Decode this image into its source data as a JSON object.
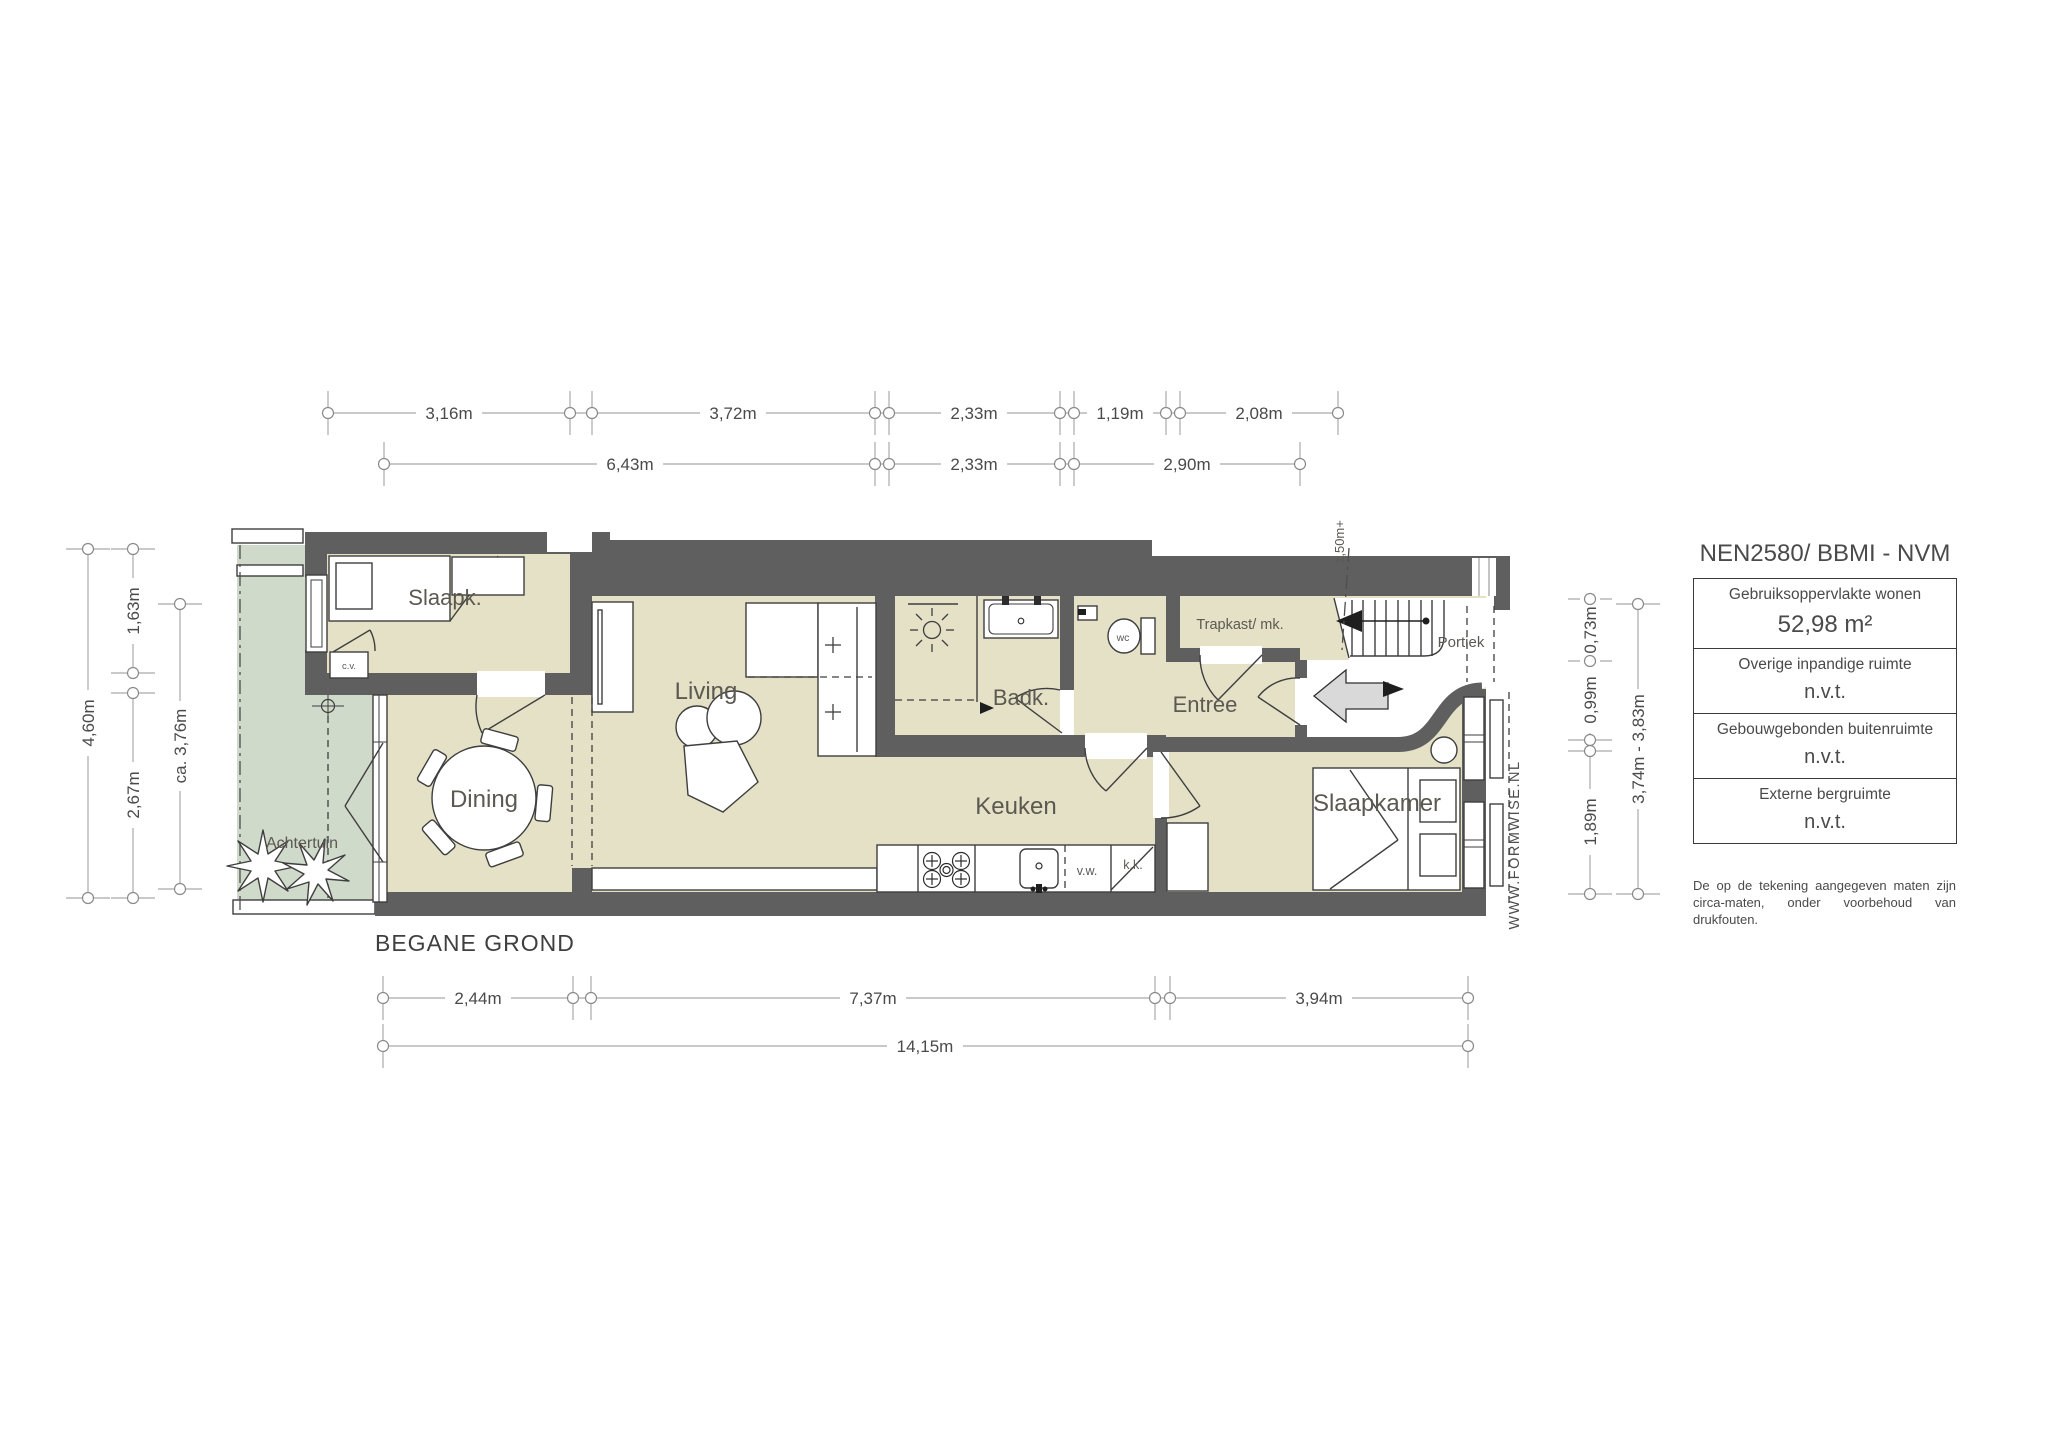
{
  "title": "BEGANE GROND",
  "watermark": "WWW.FORMWISE.NL",
  "plan": {
    "rooms": {
      "slaapk": "Slaapk.",
      "living": "Living",
      "dining": "Dining",
      "achtertuin": "Achtertuin",
      "badk": "Badk.",
      "wc": "wc",
      "trapkast": "Trapkast/ mk.",
      "entree": "Entree",
      "portiek": "Portiek",
      "keuken": "Keuken",
      "slaapkamer": "Slaapkamer",
      "cv": "c.v.",
      "vw": "v.w.",
      "kk": "k.k.",
      "height_note": "1,50m+"
    }
  },
  "dims": {
    "top1": [
      "3,16m",
      "3,72m",
      "2,33m",
      "1,19m",
      "2,08m"
    ],
    "top2": [
      "6,43m",
      "2,33m",
      "2,90m"
    ],
    "left": [
      "4,60m",
      "1,63m",
      "2,67m",
      "ca. 3,76m"
    ],
    "right": [
      "0,73m",
      "0,99m",
      "1,89m",
      "3,74m - 3,83m"
    ],
    "bottom1": [
      "2,44m",
      "7,37m",
      "3,94m"
    ],
    "bottom2": [
      "14,15m"
    ]
  },
  "panel": {
    "title": "NEN2580/ BBMI - NVM",
    "rows": [
      {
        "label": "Gebruiksoppervlakte wonen",
        "value": "52,98 m²"
      },
      {
        "label": "Overige inpandige ruimte",
        "value": "n.v.t."
      },
      {
        "label": "Gebouwgebonden buitenruimte",
        "value": "n.v.t."
      },
      {
        "label": "Externe bergruimte",
        "value": "n.v.t."
      }
    ],
    "disclaimer": "De op de tekening aangegeven maten zijn circa-maten, onder voorbehoud van drukfouten."
  },
  "colors": {
    "wall": "#5f5f5f",
    "floor": "#e4e1c6",
    "garden": "#cfdacb",
    "dimension_line": "#a9a9a9",
    "text": "#4a4a4a"
  }
}
